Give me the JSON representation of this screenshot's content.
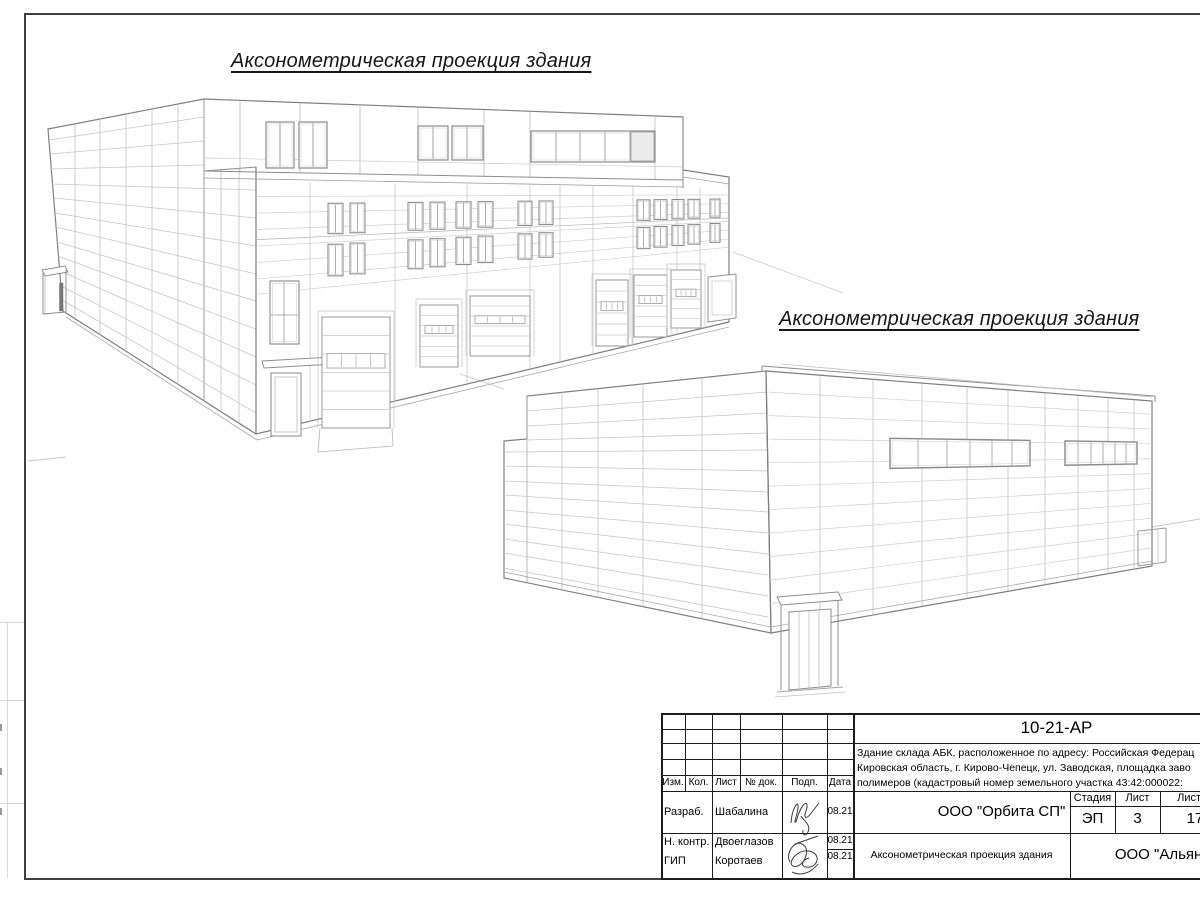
{
  "headings": {
    "h1": "Аксонометрическая проекция здания",
    "h2": "Аксонометрическая проекция здания"
  },
  "title_block": {
    "doc_code": "10-21-АР",
    "description_lines": {
      "l1": "Здание склада АБК, расположенное по адресу: Российская Федерац",
      "l2": "Кировская область, г. Кирово-Чепецк, ул. Заводская, площадка заво",
      "l3": "полимеров (кадастровый номер земельного участка 43:42:000022:"
    },
    "revision_columns": {
      "izm": "Изм.",
      "kol": "Кол.",
      "list": "Лист",
      "doc": "№ док.",
      "podp": "Подп.",
      "data": "Дата"
    },
    "signatures": {
      "razrab_role": "Разраб.",
      "razrab_name": "Шабалина",
      "razrab_date": "08.21",
      "nkontr_role": "Н. контр.",
      "nkontr_name": "Двоеглазов",
      "nkontr_date": "08.21",
      "gip_role": "ГИП",
      "gip_name": "Коротаев",
      "gip_date": "08.21"
    },
    "org_cell": "ООО \"Орбита СП\"",
    "stage": {
      "stadia_label": "Стадия",
      "list_label": "Лист",
      "listov_label": "Листов",
      "stadia": "ЭП",
      "list": "3",
      "listov": "17"
    },
    "sheet_title": "Аксонометрическая проекция здания",
    "company": "ООО \"Альянс\""
  }
}
